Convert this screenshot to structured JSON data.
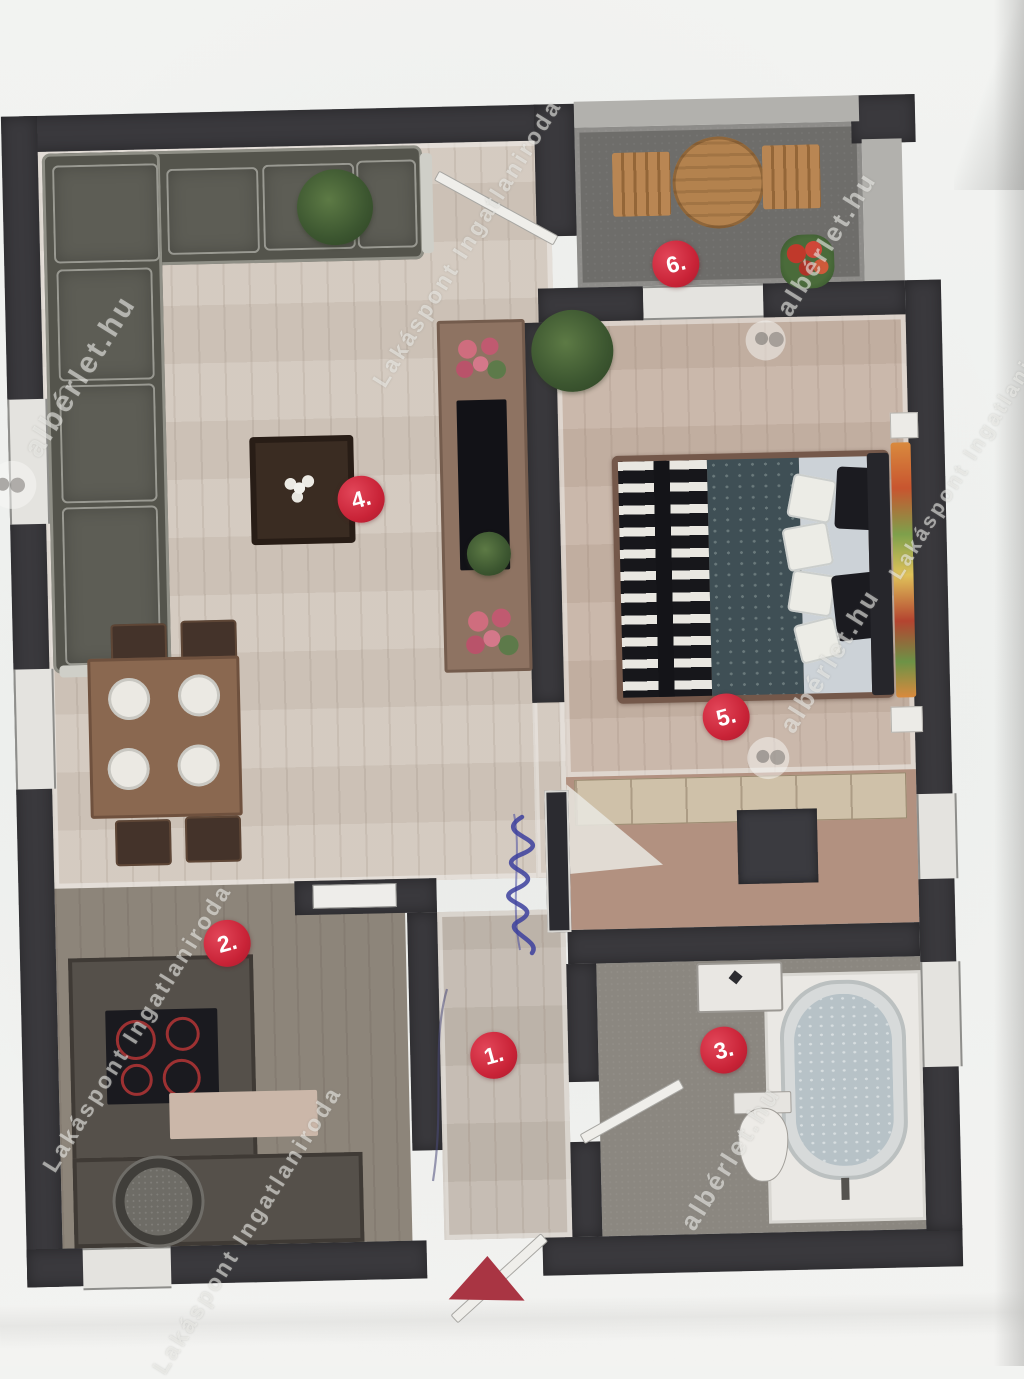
{
  "watermarks": {
    "alberlet_text": "albérlet.hu",
    "lakaspont_text": "Lakáspont Ingatlaniroda"
  },
  "markers": [
    {
      "label": "1."
    },
    {
      "label": "2."
    },
    {
      "label": "3."
    },
    {
      "label": "4."
    },
    {
      "label": "5."
    },
    {
      "label": "6."
    }
  ],
  "colors": {
    "marker_red": "#c92337",
    "wall_dark": "#3a393d",
    "paper": "#f1f2f0",
    "wood_light": "#d2c8bd",
    "wood_bed": "#c7b4a6",
    "terrace_gray": "#6e6d6a",
    "entrance_arrow_red": "#a93543",
    "pen_blue": "#3c3f9e"
  }
}
